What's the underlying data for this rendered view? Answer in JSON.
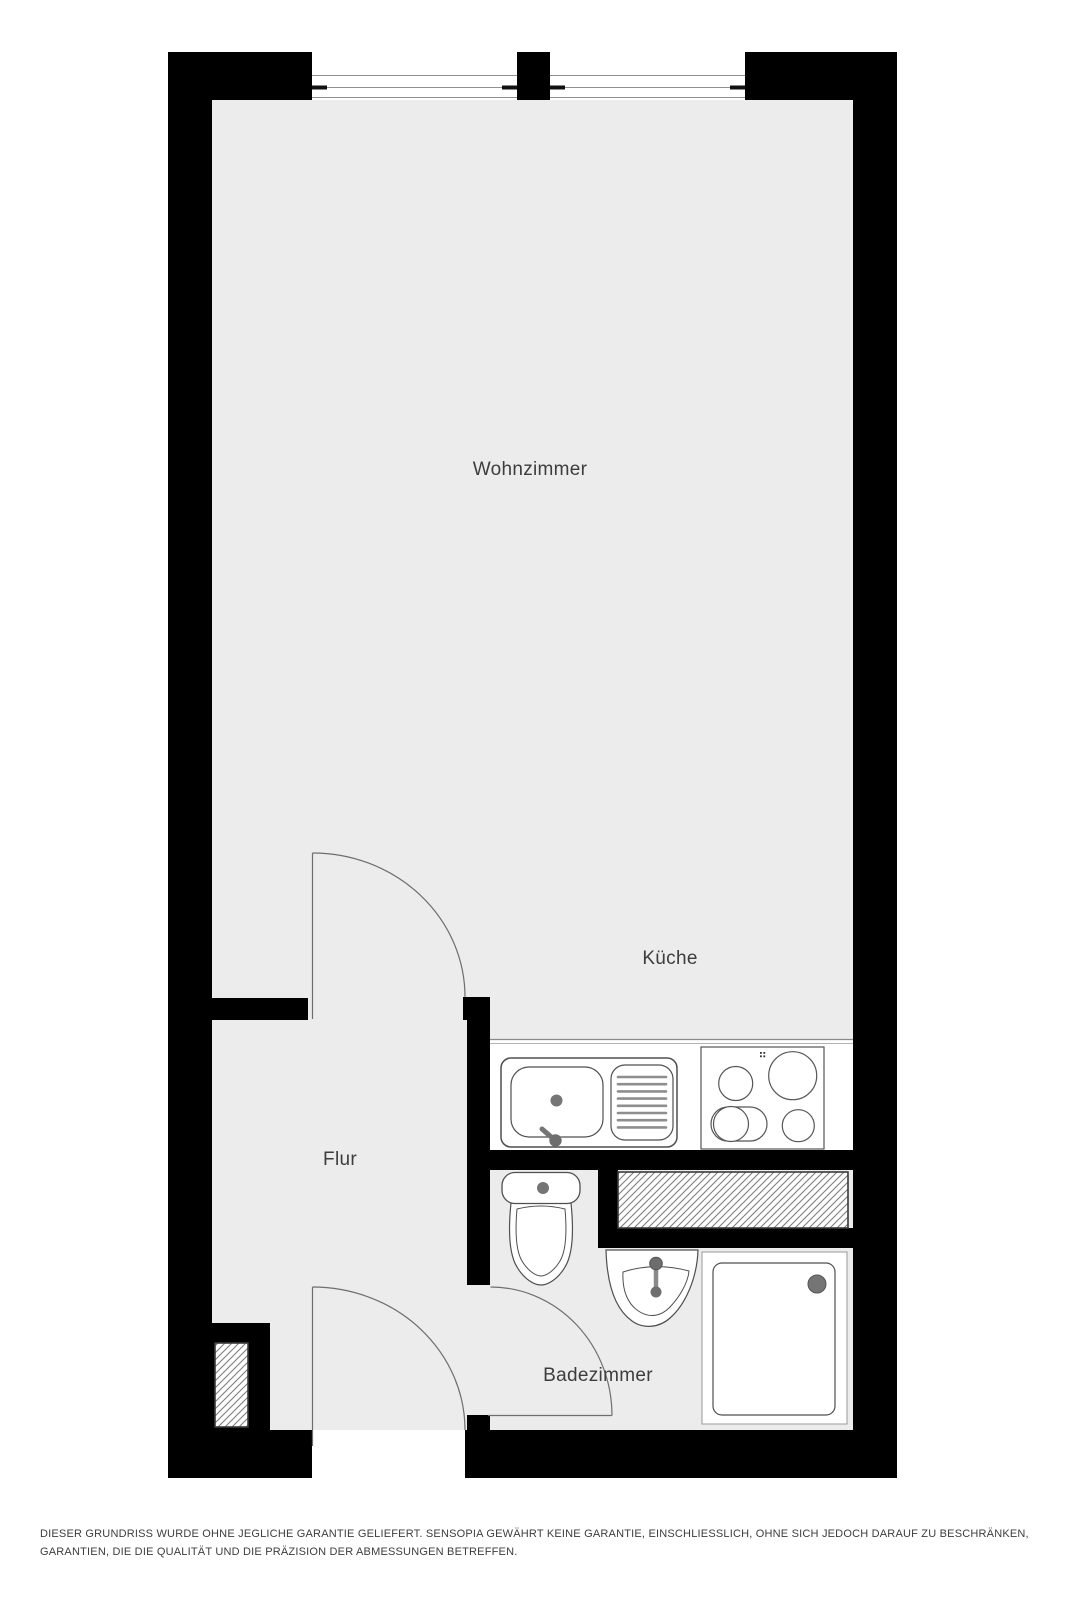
{
  "floorplan": {
    "room_labels": {
      "living_room": "Wohnzimmer",
      "kitchen": "Küche",
      "hallway": "Flur",
      "bathroom": "Badezimmer"
    },
    "disclaimer": "DIESER GRUNDRISS WURDE OHNE JEGLICHE GARANTIE GELIEFERT. SENSOPIA GEWÄHRT KEINE GARANTIE, EINSCHLIESSLICH, OHNE SICH JEDOCH DARAUF ZU BESCHRÄNKEN, GARANTIEN, DIE DIE QUALITÄT UND DIE PRÄZISION DER ABMESSUNGEN BETREFFEN.",
    "fixtures": [
      "kitchen-sink-icon",
      "drainboard-icon",
      "stove-icon",
      "toilet-icon",
      "washbasin-icon",
      "shower-icon",
      "duct-hatch-icon",
      "window-icon",
      "door-swing-icon"
    ],
    "colors": {
      "wall": "#000000",
      "floor": "#ececec",
      "text": "#3d3d3d",
      "fixture_outline": "#4f4f4f",
      "fitting_gray": "#757575",
      "window_line": "#8f8f8f"
    }
  }
}
